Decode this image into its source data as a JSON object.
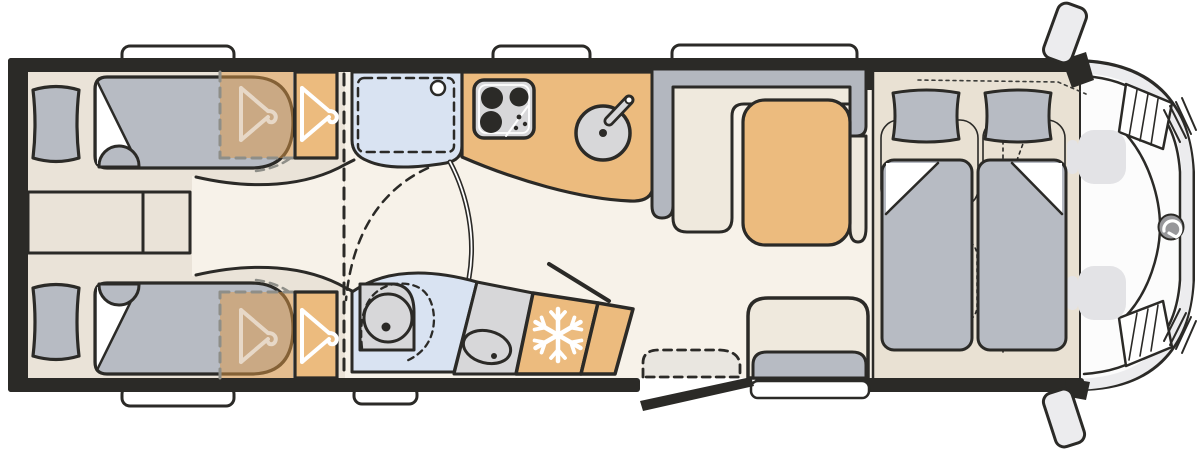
{
  "palette": {
    "outline": "#2b2a27",
    "white": "#ffffff",
    "floor": "#f7f2e9",
    "floor_bedroom": "#eae3d8",
    "floor_cab": "#e9e1d3",
    "wood": "#ecbb7e",
    "wood_overlay": "rgba(222,152,70,0.5)",
    "upholstery": "#b7bbc3",
    "backrest": "#b3b7bf",
    "cream": "#efe9dd",
    "blue": "#d9e3f2",
    "appliance": "#d7d7d9",
    "cab_body": "#fcfcfc",
    "cab_shade": "#ececee",
    "faded_seat": "#e3e3e6",
    "logo": "#97979a",
    "step": "#e9e6e0",
    "dash_gray": "#8e8e88",
    "hint": "#3c3c39",
    "seat_hint": "#c5c9cf",
    "hanger_faded": "rgba(255,255,255,0.55)"
  },
  "icons": {
    "wardrobe": "hanger-icon",
    "fridge": "snowflake-icon",
    "cab_front": "brand-logo-swirl-icon"
  },
  "areas": [
    "rear-twin-beds",
    "bedside-chest",
    "wardrobes",
    "sliding-partition",
    "shower-cubicle",
    "kitchen-block",
    "hob",
    "sink",
    "washroom-toilet",
    "vanity-basin",
    "fridge",
    "tv-panel",
    "l-shaped-dinette",
    "dinette-table",
    "side-bench",
    "entry-door",
    "entry-step",
    "drop-down-beds",
    "cab-seats",
    "cab-front",
    "exterior-mirrors",
    "roof-skylights"
  ]
}
